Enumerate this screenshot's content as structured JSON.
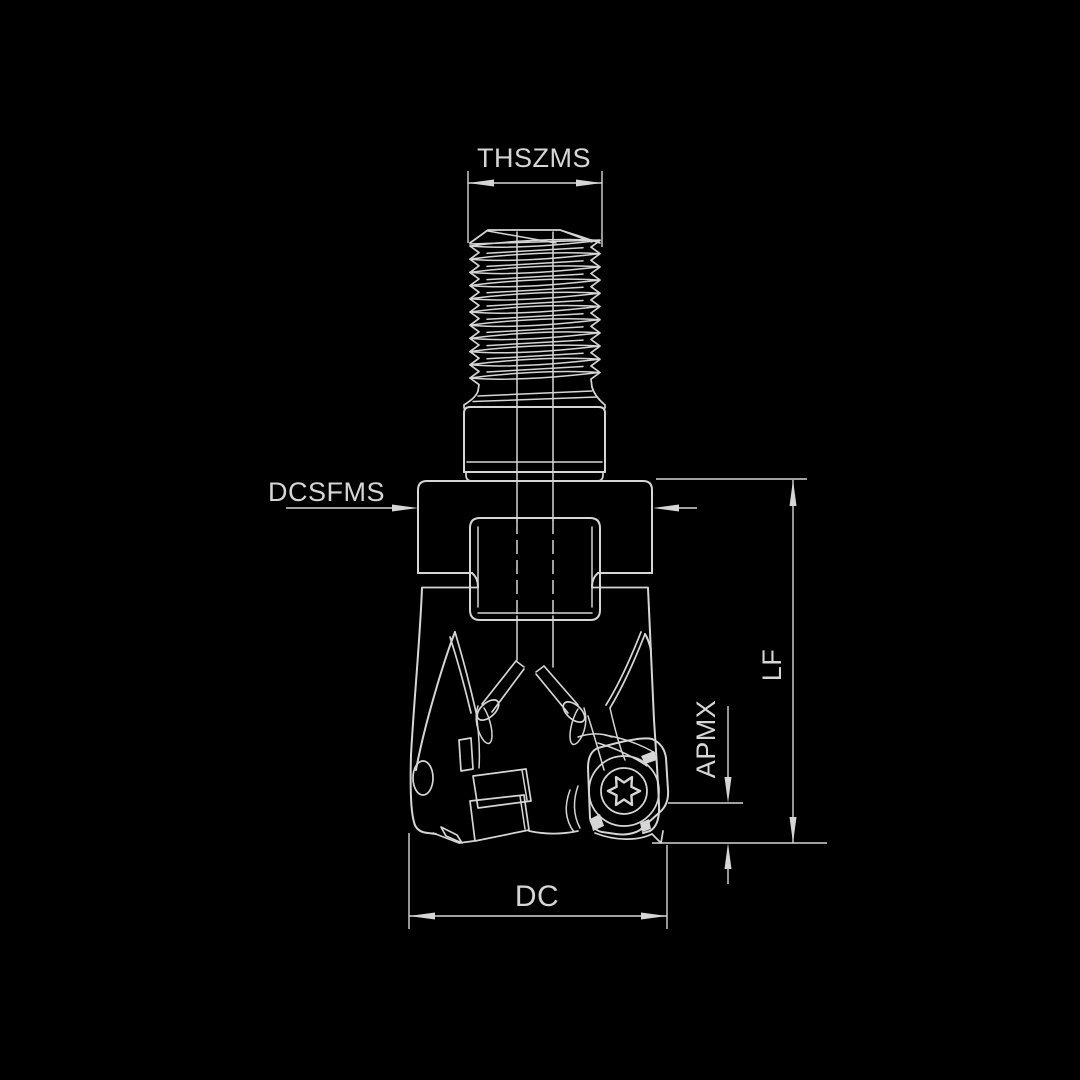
{
  "diagram": {
    "type": "technical-drawing",
    "subject": "indexable-end-mill-side-view",
    "labels": {
      "thszms": "THSZMS",
      "dcsfms": "DCSFMS",
      "lf": "LF",
      "apmx": "APMX",
      "dc": "DC"
    },
    "colors": {
      "background": "#000000",
      "line": "#d6d6d6",
      "text": "#d6d6d6"
    }
  }
}
